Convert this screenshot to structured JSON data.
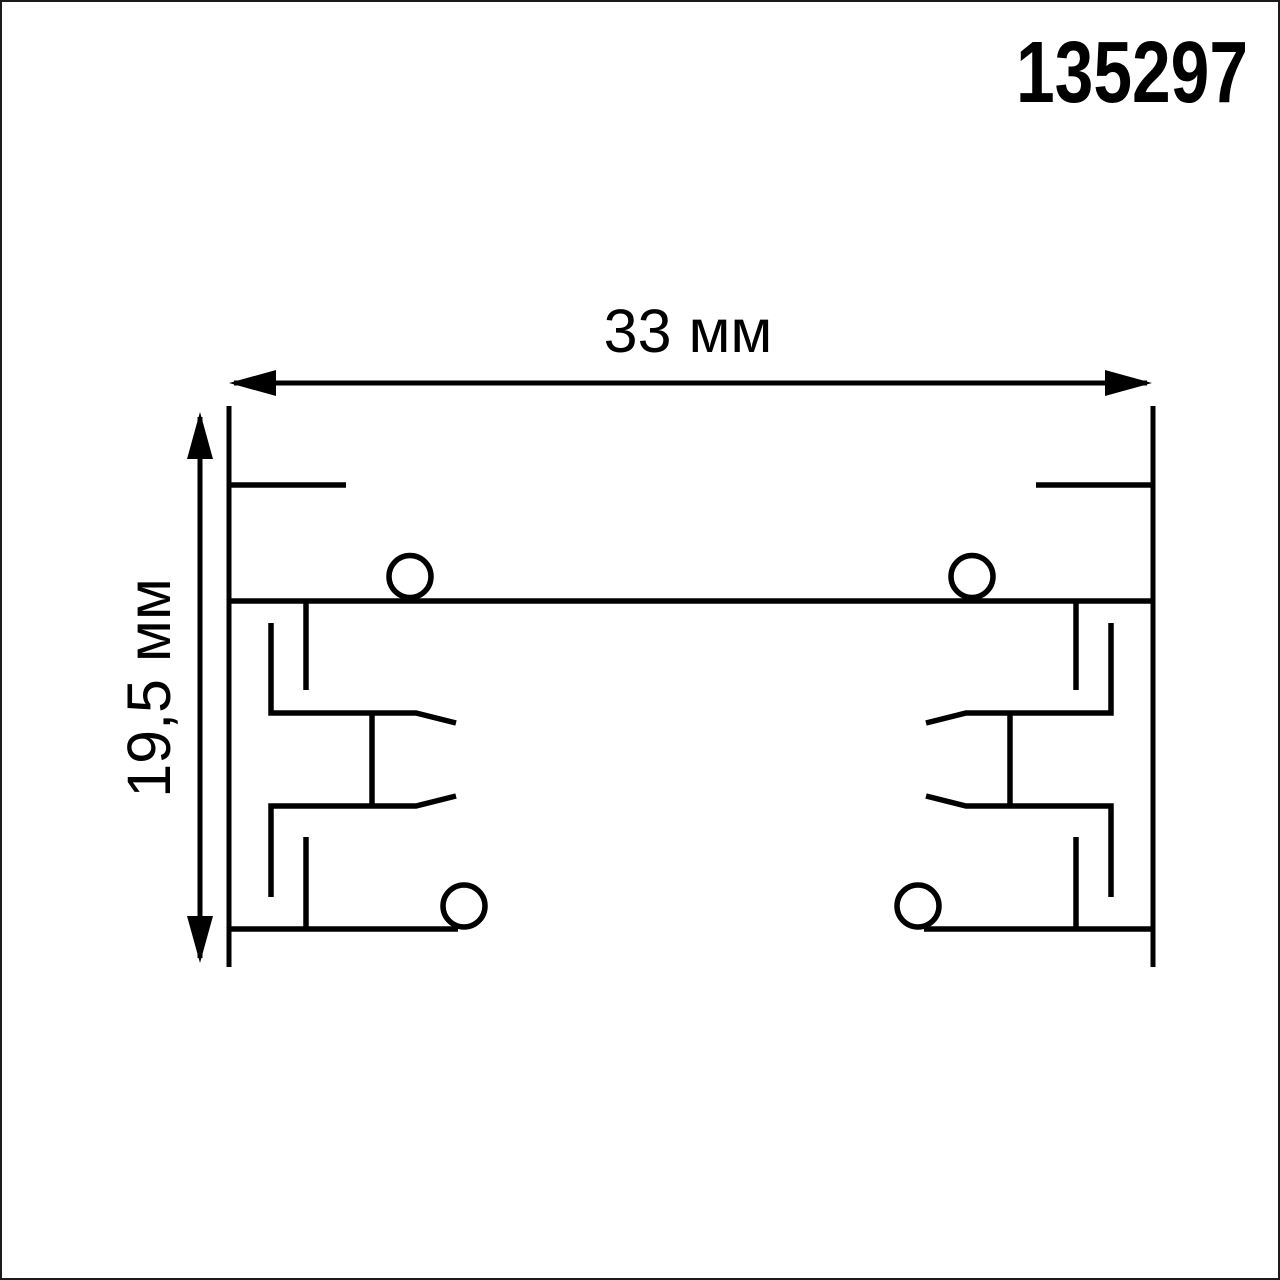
{
  "page": {
    "background": "#ffffff",
    "border_color": "#1a1a1a"
  },
  "drawing": {
    "product_code": "135297",
    "width_dimension_label": "33 мм",
    "height_dimension_label": "19,5 мм",
    "line_color": "#000000"
  }
}
